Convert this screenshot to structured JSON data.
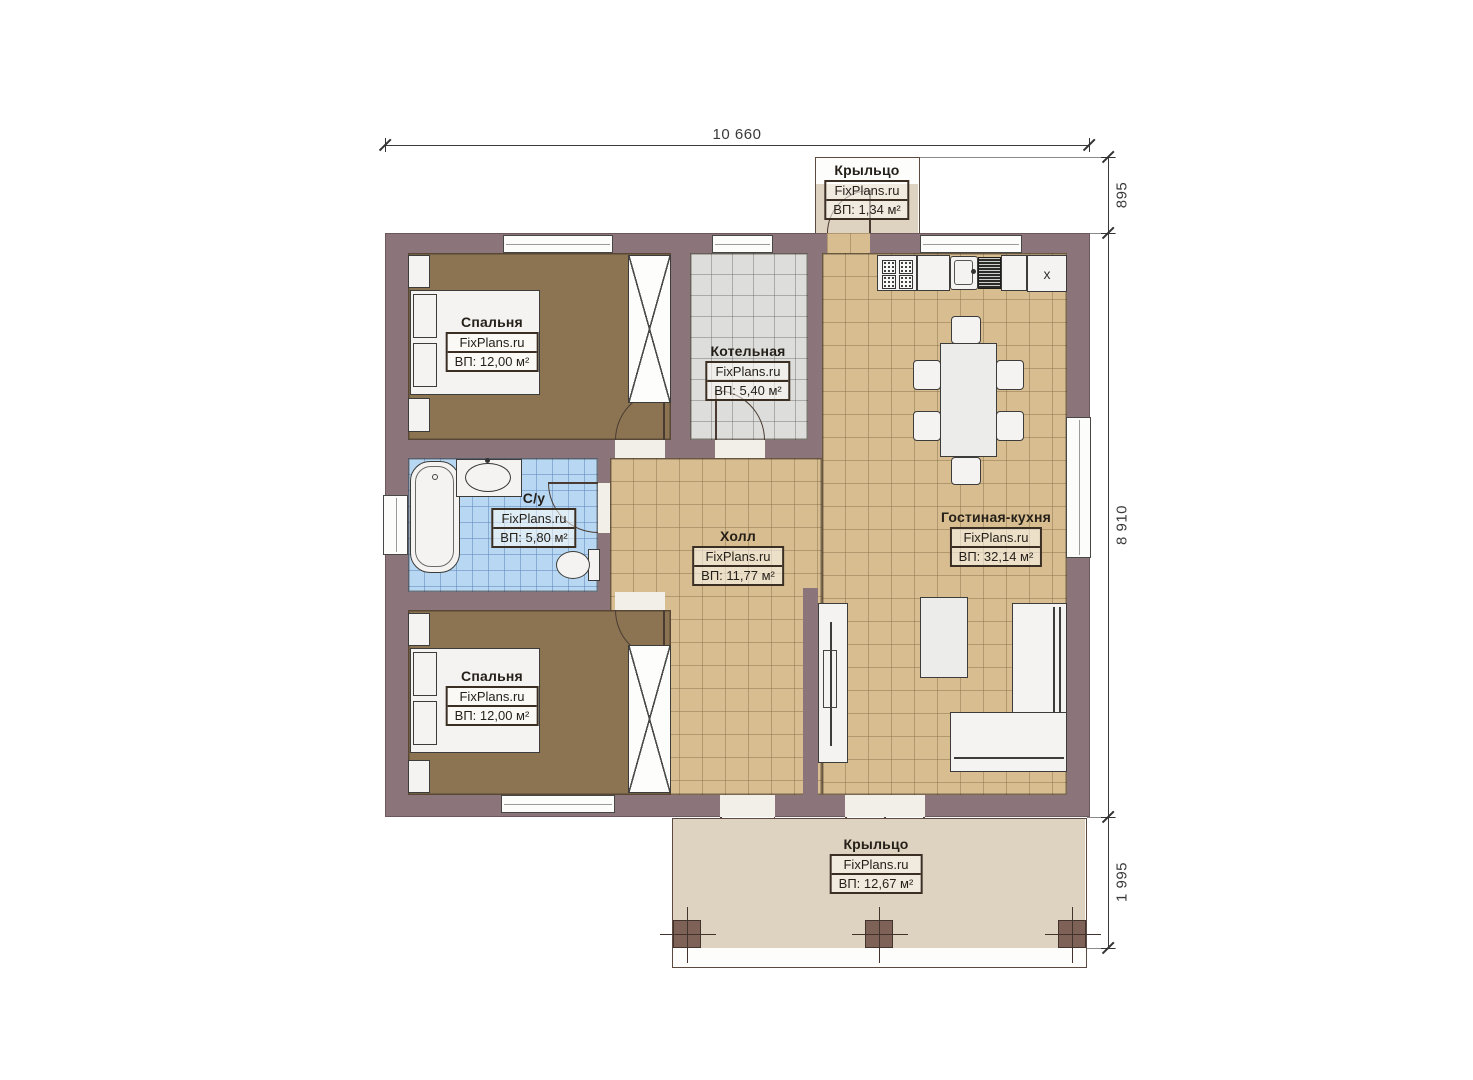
{
  "plan": {
    "dimensions": {
      "total_width": "10 660",
      "porch_top_depth": "895",
      "house_depth": "8 910",
      "porch_bottom_depth": "1 995"
    },
    "rooms": {
      "bedroom_top": {
        "name": "Спальня",
        "brand": "FixPlans.ru",
        "area": "ВП: 12,00 м²"
      },
      "boiler": {
        "name": "Котельная",
        "brand": "FixPlans.ru",
        "area": "ВП: 5,40 м²"
      },
      "bathroom": {
        "name": "С/у",
        "brand": "FixPlans.ru",
        "area": "ВП: 5,80 м²"
      },
      "hall": {
        "name": "Холл",
        "brand": "FixPlans.ru",
        "area": "ВП: 11,77 м²"
      },
      "living_kitchen": {
        "name": "Гостиная-кухня",
        "brand": "FixPlans.ru",
        "area": "ВП: 32,14 м²"
      },
      "bedroom_bottom": {
        "name": "Спальня",
        "brand": "FixPlans.ru",
        "area": "ВП: 12,00 м²"
      },
      "porch_top": {
        "name": "Крыльцо",
        "brand": "FixPlans.ru",
        "area": "ВП: 1,34 м²"
      },
      "porch_bottom": {
        "name": "Крыльцо",
        "brand": "FixPlans.ru",
        "area": "ВП: 12,67 м²"
      }
    },
    "appliances": {
      "fridge_mark": "x"
    },
    "colors": {
      "wall": "#8b757b",
      "bedroom_floor": "#8c7453",
      "tile_tan": "#d7bd90",
      "tile_gray": "#dddddb",
      "tile_blue": "#b7d7f2",
      "porch": "#ded2c0"
    }
  }
}
